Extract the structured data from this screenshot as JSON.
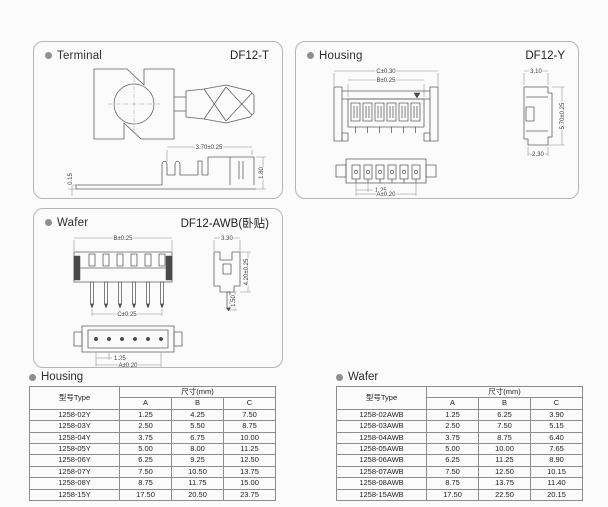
{
  "panels": {
    "terminal": {
      "title": "Terminal",
      "part_no": "DF12-T",
      "dims": {
        "length": "3.70±0.25",
        "thickness": "0.15",
        "height": "1.80"
      }
    },
    "housing": {
      "title": "Housing",
      "part_no": "DF12-Y",
      "dims": {
        "c": "C±0.30",
        "b": "B±0.25",
        "side_width": "3.10",
        "side_height": "5.70±0.25",
        "side_depth": "2.30",
        "pitch": "1.25",
        "a": "A±0.20"
      }
    },
    "wafer": {
      "title": "Wafer",
      "part_no": "DF12-AWB(卧贴)",
      "dims": {
        "b": "B±0.25",
        "c": "C±0.25",
        "side_width": "3.30",
        "pin_length": "1.50",
        "side_height": "4.20±0.25",
        "pitch": "1.25",
        "a": "A±0.20"
      }
    }
  },
  "tables": {
    "housing": {
      "title": "Housing",
      "type_header": "型号Type",
      "size_header": "尺寸(mm)",
      "columns": [
        "A",
        "B",
        "C"
      ],
      "rows": [
        [
          "1258-02Y",
          "1.25",
          "4.25",
          "7.50"
        ],
        [
          "1258-03Y",
          "2.50",
          "5.50",
          "8.75"
        ],
        [
          "1258-04Y",
          "3.75",
          "6.75",
          "10.00"
        ],
        [
          "1258-05Y",
          "5.00",
          "8.00",
          "11.25"
        ],
        [
          "1258-06Y",
          "6.25",
          "9.25",
          "12.50"
        ],
        [
          "1258-07Y",
          "7.50",
          "10.50",
          "13.75"
        ],
        [
          "1258-08Y",
          "8.75",
          "11.75",
          "15.00"
        ],
        [
          "1258-15Y",
          "17.50",
          "20.50",
          "23.75"
        ]
      ]
    },
    "wafer": {
      "title": "Wafer",
      "type_header": "型号Type",
      "size_header": "尺寸(mm)",
      "columns": [
        "A",
        "B",
        "C"
      ],
      "rows": [
        [
          "1258-02AWB",
          "1.25",
          "6.25",
          "3.90"
        ],
        [
          "1258-03AWB",
          "2.50",
          "7.50",
          "5.15"
        ],
        [
          "1258-04AWB",
          "3.75",
          "8.75",
          "6.40"
        ],
        [
          "1258-05AWB",
          "5.00",
          "10.00",
          "7.65"
        ],
        [
          "1258-06AWB",
          "6.25",
          "11.25",
          "8.90"
        ],
        [
          "1258-07AWB",
          "7.50",
          "12.50",
          "10.15"
        ],
        [
          "1258-08AWB",
          "8.75",
          "13.75",
          "11.40"
        ],
        [
          "1258-15AWB",
          "17.50",
          "22.50",
          "20.15"
        ]
      ]
    }
  }
}
